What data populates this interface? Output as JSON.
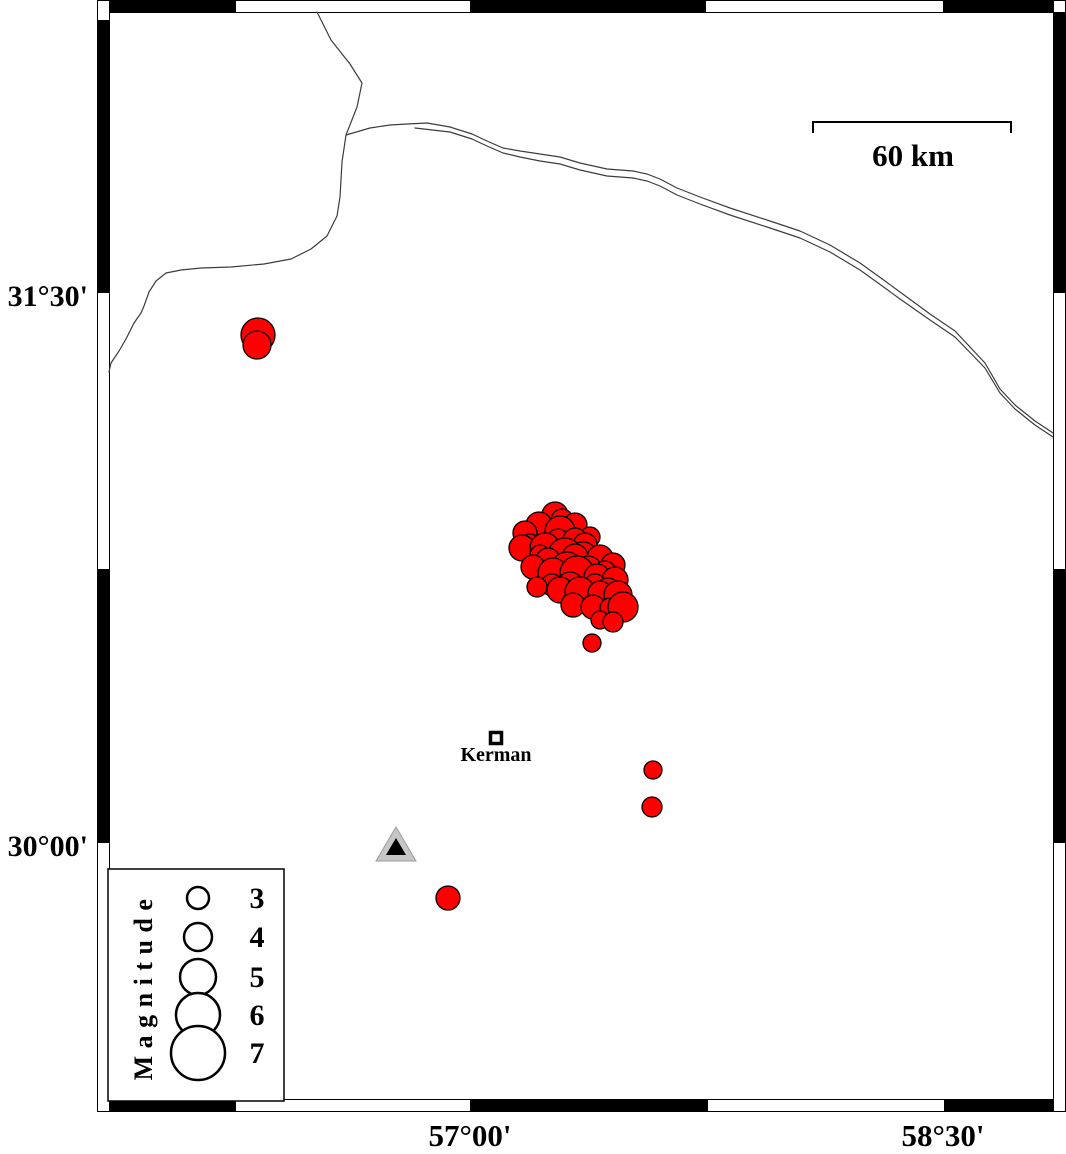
{
  "map": {
    "colors": {
      "epicenter_fill": "#ff0000",
      "epicenter_stroke": "#000000",
      "boundary_line": "#3d3d3d",
      "frame_fill": "#000000",
      "station_fill": "#c6c6c6",
      "station_inner": "#000000"
    },
    "frame": {
      "outer": {
        "x": 97,
        "y": 0,
        "w": 969,
        "h": 1112
      },
      "inner": {
        "x": 109,
        "y": 12,
        "w": 945,
        "h": 1088
      },
      "band": 12,
      "black_segments": {
        "top": [
          [
            109,
            236
          ],
          [
            470,
            706
          ],
          [
            943,
            1054
          ]
        ],
        "bottom": [
          [
            109,
            236
          ],
          [
            470,
            708
          ],
          [
            944,
            1054
          ]
        ],
        "left": [
          [
            20,
            293
          ],
          [
            569,
            843
          ]
        ],
        "right": [
          [
            12,
            293
          ],
          [
            569,
            843
          ]
        ]
      }
    },
    "axis": {
      "left": [
        {
          "label": "31°30'",
          "y": 306
        },
        {
          "label": "30°00'",
          "y": 856
        }
      ],
      "bottom": [
        {
          "label": "57°00'",
          "x": 470,
          "y": 1146
        },
        {
          "label": "58°30'",
          "x": 943,
          "y": 1146
        }
      ]
    },
    "scale_bar": {
      "label": "60 km",
      "x1": 813,
      "x2": 1011,
      "y": 122,
      "drop": 11
    },
    "city": {
      "label": "Kerman",
      "x": 496,
      "y": 738
    },
    "station": {
      "x": 396,
      "y": 848
    },
    "boundaries": [
      {
        "name": "north",
        "points": [
          [
            317,
            12
          ],
          [
            331,
            40
          ],
          [
            350,
            64
          ],
          [
            362,
            83
          ],
          [
            357,
            107
          ],
          [
            346,
            135
          ]
        ]
      },
      {
        "name": "west",
        "points": [
          [
            346,
            135
          ],
          [
            342,
            162
          ],
          [
            340,
            197
          ],
          [
            337,
            216
          ],
          [
            327,
            236
          ],
          [
            311,
            249
          ],
          [
            291,
            259
          ],
          [
            264,
            264
          ],
          [
            231,
            267
          ],
          [
            201,
            268
          ],
          [
            181,
            270
          ],
          [
            166,
            273
          ],
          [
            156,
            281
          ],
          [
            149,
            292
          ],
          [
            144,
            306
          ],
          [
            141,
            313
          ],
          [
            134,
            323
          ],
          [
            126,
            339
          ],
          [
            119,
            351
          ],
          [
            111,
            363
          ],
          [
            109,
            372
          ]
        ]
      },
      {
        "name": "east-upper",
        "points": [
          [
            346,
            135
          ],
          [
            370,
            128
          ],
          [
            390,
            125
          ],
          [
            407,
            124
          ],
          [
            427,
            123
          ],
          [
            450,
            127
          ],
          [
            472,
            134
          ],
          [
            487,
            141
          ],
          [
            503,
            148
          ],
          [
            520,
            151
          ],
          [
            540,
            154
          ],
          [
            560,
            157
          ],
          [
            580,
            163
          ],
          [
            607,
            169
          ],
          [
            633,
            171
          ],
          [
            647,
            174
          ],
          [
            660,
            179
          ],
          [
            677,
            188
          ],
          [
            700,
            197
          ],
          [
            730,
            208
          ],
          [
            770,
            221
          ],
          [
            800,
            231
          ],
          [
            830,
            245
          ],
          [
            860,
            263
          ],
          [
            885,
            281
          ],
          [
            900,
            292
          ],
          [
            930,
            314
          ],
          [
            955,
            331
          ],
          [
            985,
            363
          ],
          [
            1000,
            389
          ],
          [
            1015,
            405
          ],
          [
            1035,
            421
          ],
          [
            1053,
            433
          ]
        ]
      },
      {
        "name": "east-lower",
        "points": [
          [
            415,
            128
          ],
          [
            450,
            132
          ],
          [
            472,
            139
          ],
          [
            487,
            146
          ],
          [
            503,
            153
          ],
          [
            520,
            157
          ],
          [
            540,
            161
          ],
          [
            560,
            164
          ],
          [
            580,
            170
          ],
          [
            607,
            176
          ],
          [
            633,
            178
          ],
          [
            647,
            181
          ],
          [
            660,
            186
          ],
          [
            677,
            195
          ],
          [
            700,
            204
          ],
          [
            730,
            215
          ],
          [
            770,
            228
          ],
          [
            800,
            238
          ],
          [
            830,
            252
          ],
          [
            860,
            270
          ],
          [
            885,
            288
          ],
          [
            900,
            299
          ],
          [
            930,
            320
          ],
          [
            955,
            337
          ],
          [
            985,
            368
          ],
          [
            1000,
            393
          ],
          [
            1015,
            409
          ],
          [
            1035,
            425
          ],
          [
            1053,
            437
          ]
        ]
      }
    ],
    "earthquakes": {
      "points": [
        [
          258,
          335,
          17
        ],
        [
          257,
          345,
          14
        ],
        [
          555,
          515,
          13
        ],
        [
          562,
          520,
          11
        ],
        [
          539,
          525,
          13
        ],
        [
          575,
          525,
          12
        ],
        [
          560,
          531,
          15
        ],
        [
          525,
          533,
          12
        ],
        [
          590,
          537,
          10
        ],
        [
          558,
          540,
          11
        ],
        [
          575,
          540,
          12
        ],
        [
          585,
          545,
          12
        ],
        [
          530,
          545,
          11
        ],
        [
          522,
          548,
          13
        ],
        [
          545,
          548,
          15
        ],
        [
          540,
          555,
          10
        ],
        [
          565,
          555,
          17
        ],
        [
          583,
          557,
          15
        ],
        [
          600,
          558,
          13
        ],
        [
          575,
          557,
          13
        ],
        [
          548,
          560,
          12
        ],
        [
          613,
          565,
          12
        ],
        [
          533,
          567,
          12
        ],
        [
          567,
          568,
          16
        ],
        [
          588,
          570,
          14
        ],
        [
          605,
          572,
          11
        ],
        [
          553,
          573,
          15
        ],
        [
          577,
          573,
          17
        ],
        [
          597,
          577,
          13
        ],
        [
          615,
          580,
          13
        ],
        [
          570,
          585,
          13
        ],
        [
          552,
          585,
          11
        ],
        [
          595,
          585,
          11
        ],
        [
          537,
          587,
          10
        ],
        [
          560,
          590,
          13
        ],
        [
          608,
          590,
          12
        ],
        [
          580,
          592,
          15
        ],
        [
          600,
          593,
          12
        ],
        [
          618,
          595,
          14
        ],
        [
          573,
          605,
          12
        ],
        [
          593,
          607,
          12
        ],
        [
          610,
          608,
          10
        ],
        [
          623,
          607,
          15
        ],
        [
          600,
          620,
          9
        ],
        [
          613,
          622,
          10
        ],
        [
          592,
          643,
          9
        ],
        [
          653,
          770,
          9
        ],
        [
          652,
          807,
          10
        ],
        [
          448,
          898,
          12
        ]
      ]
    },
    "legend": {
      "title": "Magnitude",
      "box": {
        "x": 108,
        "y": 869,
        "w": 176,
        "h": 232
      },
      "circle_cx": 198,
      "label_x": 257,
      "items": [
        {
          "label": "3",
          "cy": 898,
          "r": 11
        },
        {
          "label": "4",
          "cy": 937,
          "r": 14
        },
        {
          "label": "5",
          "cy": 977,
          "r": 18
        },
        {
          "label": "6",
          "cy": 1015,
          "r": 22
        },
        {
          "label": "7",
          "cy": 1053,
          "r": 27
        }
      ]
    }
  }
}
